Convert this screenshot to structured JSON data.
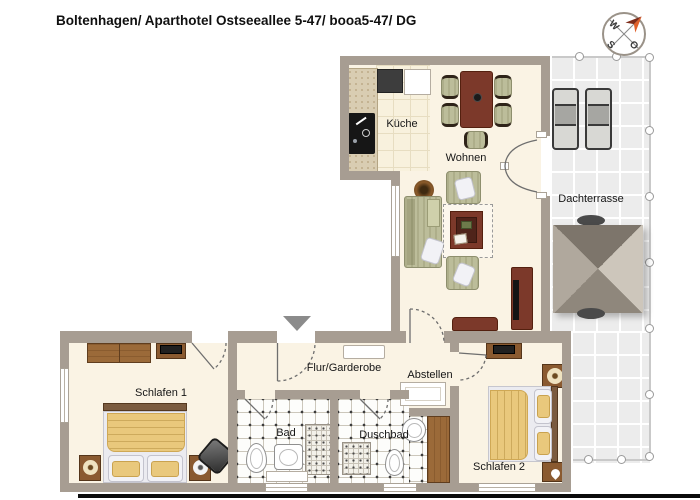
{
  "header": {
    "title": "Boltenhagen/ Aparthotel Ostseeallee 5-47/ booa5-47/ DG"
  },
  "compass": {
    "west": "W",
    "south": "S",
    "east": "O",
    "arrow_color": "#e0602a"
  },
  "rooms": {
    "kueche": {
      "label": "Küche"
    },
    "wohnen": {
      "label": "Wohnen"
    },
    "dachterrasse": {
      "label": "Dachterrasse"
    },
    "flur": {
      "label": "Flur/Garderobe"
    },
    "abstellen": {
      "label": "Abstellen"
    },
    "schlafen1": {
      "label": "Schlafen 1"
    },
    "bad": {
      "label": "Bad"
    },
    "duschbad": {
      "label": "Duschbad"
    },
    "schlafen2": {
      "label": "Schlafen 2"
    }
  },
  "colors": {
    "wall": "#a79d92",
    "room_floor": "#faf3e4",
    "terrace_tile": "#ececec",
    "wood": "#9b6a39",
    "furniture_maroon": "#7c392a",
    "upholstery_sage": "#bcbd9a",
    "bedding_yellow": "#e9c87c",
    "compass_arrow": "#e0602a"
  }
}
